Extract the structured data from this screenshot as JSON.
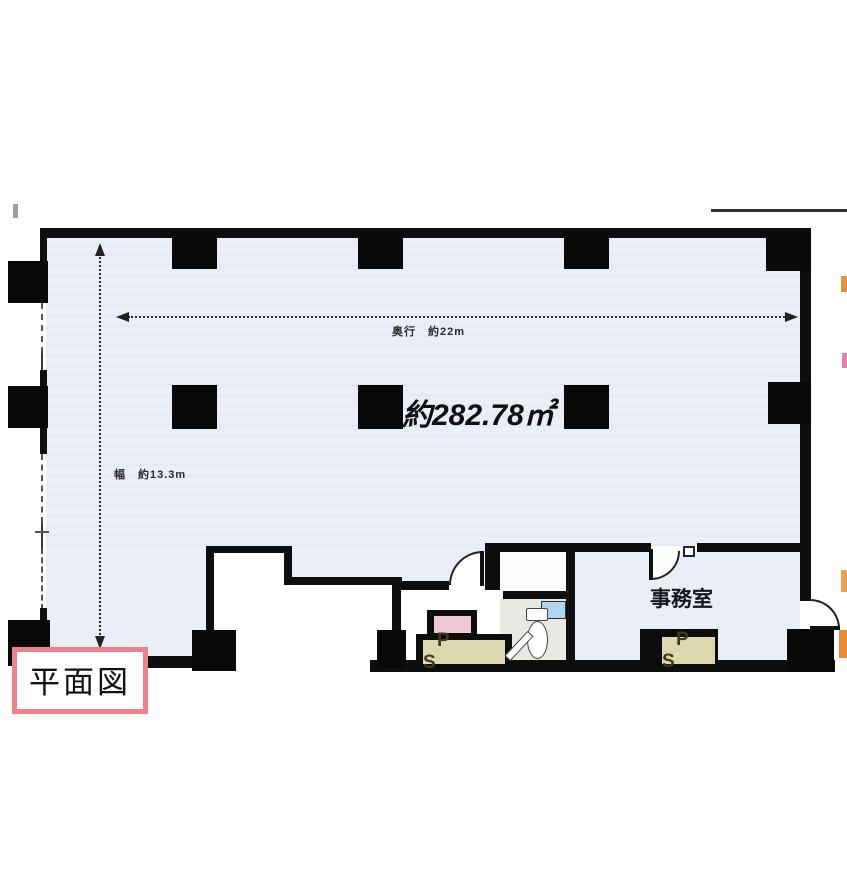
{
  "plan": {
    "title_box": {
      "label": "平面図"
    },
    "area_label": "約282.78㎡",
    "office_label": "事務室",
    "dimensions": {
      "depth": {
        "label": "奥行　約22m"
      },
      "width": {
        "label": "幅　約13.3m"
      }
    },
    "ps_boxes": [
      {
        "label": "P S"
      },
      {
        "label": "P S"
      }
    ],
    "colors": {
      "floor_blue": "#e9eef7",
      "wall_black": "#0e0e0e",
      "ps_fill": "#ddd7ad",
      "ps_text": "#3c3c20",
      "pink_fixture": "#eec9d4",
      "window_blue": "#aed5f2",
      "toilet_floor_gray": "#e9e9e3",
      "title_border_pink": "#f2808a"
    }
  }
}
